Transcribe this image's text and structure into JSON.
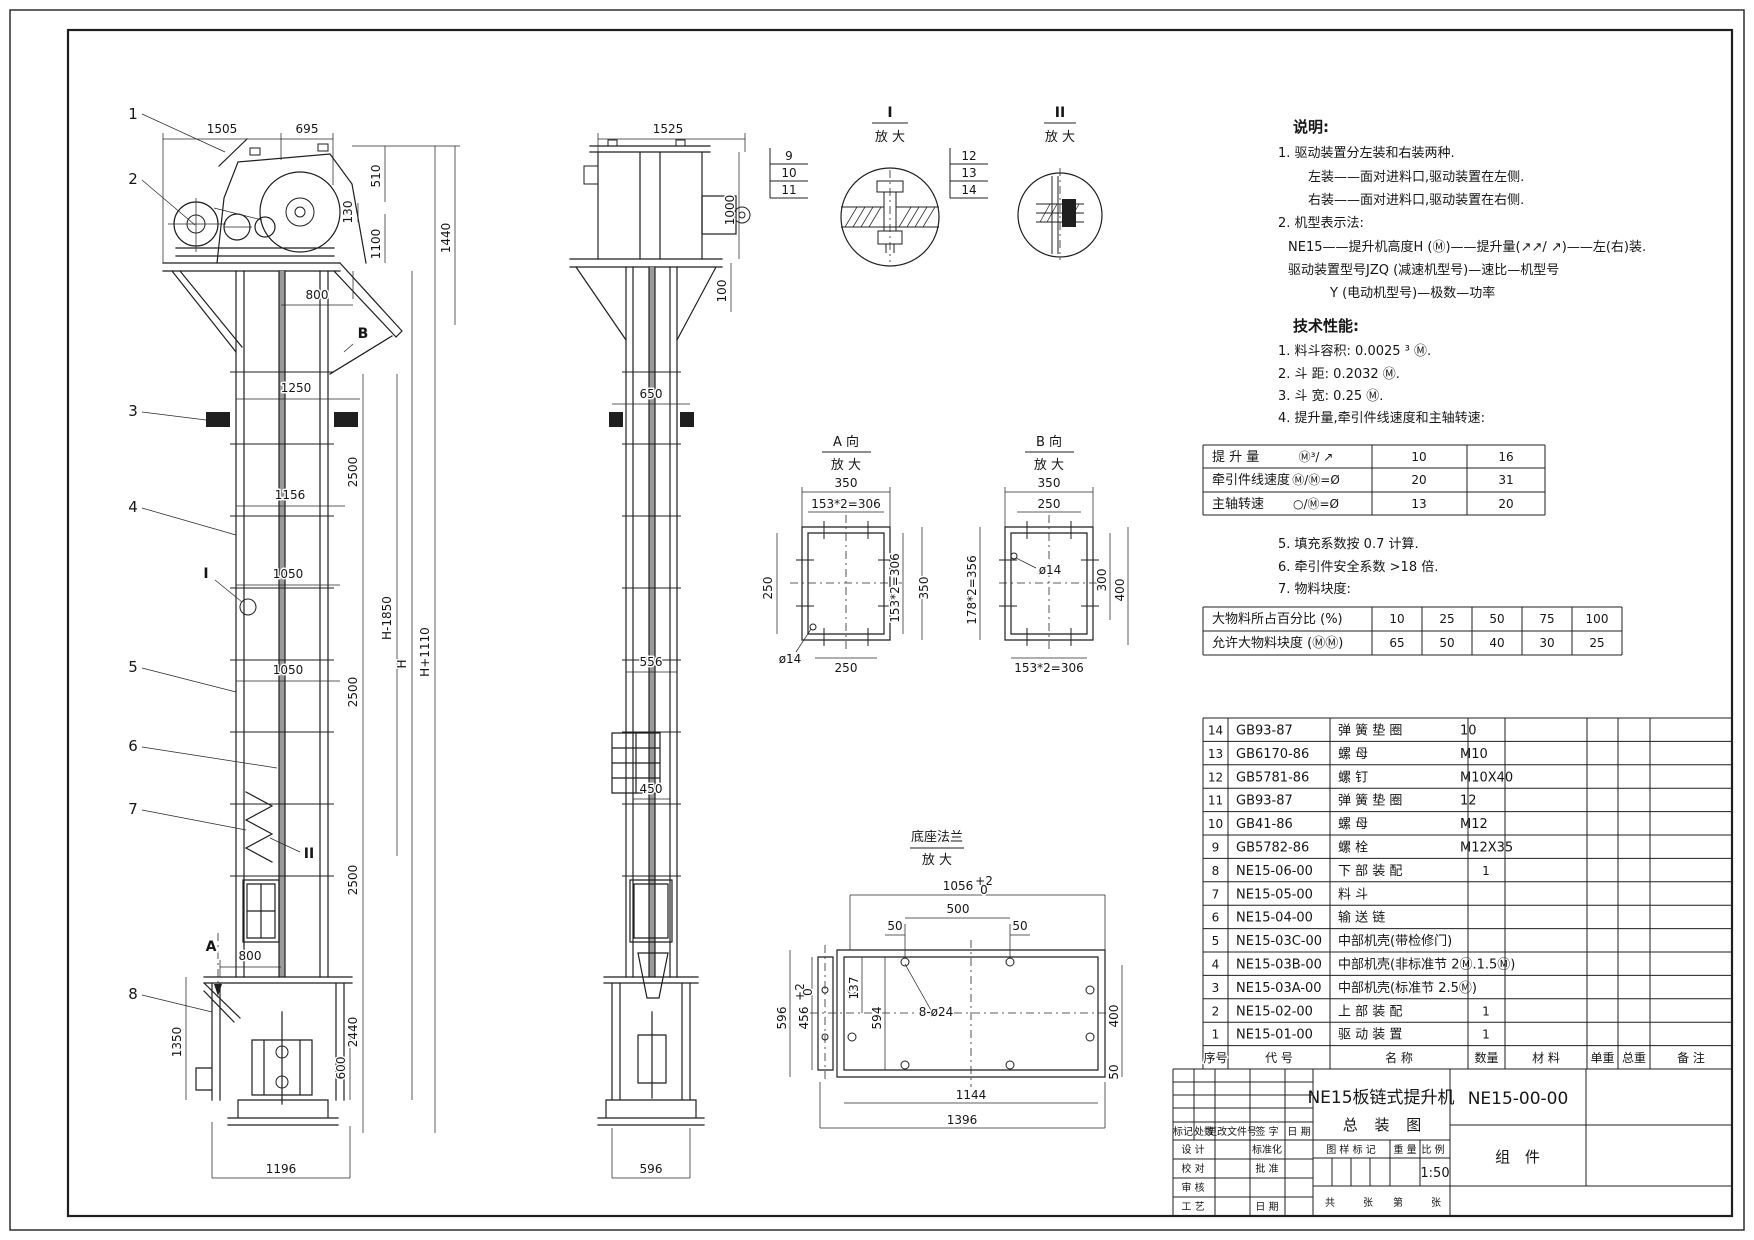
{
  "title_block": {
    "product_title_line1": "NE15板链式提升机",
    "product_title_line2": "总 装 图",
    "drawing_number": "NE15-00-00",
    "sheet_label": "组 件",
    "scale_value": "1:50",
    "cells": [
      {
        "t": "标记",
        "x": 1183,
        "y": 1135,
        "fs": 8
      },
      {
        "t": "处数",
        "x": 1204,
        "y": 1135,
        "fs": 8
      },
      {
        "t": "更改文件号",
        "x": 1232,
        "y": 1135,
        "fs": 8
      },
      {
        "t": "签  字",
        "x": 1267,
        "y": 1135,
        "fs": 8
      },
      {
        "t": "日  期",
        "x": 1299,
        "y": 1135,
        "fs": 8
      },
      {
        "t": "设  计",
        "x": 1193,
        "y": 1153,
        "fs": 10
      },
      {
        "t": "标准化",
        "x": 1267,
        "y": 1153,
        "fs": 10
      },
      {
        "t": "校  对",
        "x": 1193,
        "y": 1172,
        "fs": 10
      },
      {
        "t": "批  准",
        "x": 1267,
        "y": 1172,
        "fs": 10
      },
      {
        "t": "审  核",
        "x": 1193,
        "y": 1191,
        "fs": 10
      },
      {
        "t": "工  艺",
        "x": 1193,
        "y": 1210,
        "fs": 10
      },
      {
        "t": "日  期",
        "x": 1267,
        "y": 1210,
        "fs": 10
      },
      {
        "t": "图 样 标 记",
        "x": 1351,
        "y": 1153,
        "fs": 10
      },
      {
        "t": "重 量",
        "x": 1405,
        "y": 1153,
        "fs": 10
      },
      {
        "t": "比 例",
        "x": 1433,
        "y": 1153,
        "fs": 10
      },
      {
        "t": "共",
        "x": 1330,
        "y": 1206,
        "fs": 10
      },
      {
        "t": "张",
        "x": 1368,
        "y": 1206,
        "fs": 10
      },
      {
        "t": "第",
        "x": 1398,
        "y": 1206,
        "fs": 10
      },
      {
        "t": "张",
        "x": 1436,
        "y": 1206,
        "fs": 10
      }
    ]
  },
  "notes": [
    {
      "t": "说明:",
      "x": 1293,
      "y": 132,
      "cls": "note-h"
    },
    {
      "t": "1. 驱动装置分左装和右装两种.",
      "x": 1278,
      "y": 157
    },
    {
      "t": "左装——面对进料口,驱动装置在左侧.",
      "x": 1308,
      "y": 181
    },
    {
      "t": "右装——面对进料口,驱动装置在右侧.",
      "x": 1308,
      "y": 204
    },
    {
      "t": "2. 机型表示法:",
      "x": 1278,
      "y": 227
    },
    {
      "t": "NE15——提升机高度H (Ⓜ)——提升量(↗↗/ ↗)——左(右)装.",
      "x": 1288,
      "y": 251
    },
    {
      "t": "驱动装置型号JZQ    (减速机型号)—速比—机型号",
      "x": 1288,
      "y": 274
    },
    {
      "t": "Y  (电动机型号)—极数—功率",
      "x": 1330,
      "y": 297
    },
    {
      "t": "技术性能:",
      "x": 1293,
      "y": 331,
      "cls": "note-h"
    },
    {
      "t": "1. 料斗容积: 0.0025 ³  Ⓜ.",
      "x": 1278,
      "y": 355
    },
    {
      "t": "2. 斗    距: 0.2032  Ⓜ.",
      "x": 1278,
      "y": 378
    },
    {
      "t": "3. 斗    宽: 0.25  Ⓜ.",
      "x": 1278,
      "y": 400
    },
    {
      "t": "4. 提升量,牵引件线速度和主轴转速:",
      "x": 1278,
      "y": 422
    },
    {
      "t": "5. 填充系数按 0.7   计算.",
      "x": 1278,
      "y": 548
    },
    {
      "t": "6. 牵引件安全系数 >18   倍.",
      "x": 1278,
      "y": 571
    },
    {
      "t": "7. 物料块度:",
      "x": 1278,
      "y": 593
    }
  ],
  "annotations": {
    "front_dims": [
      {
        "t": "1505",
        "x": 222,
        "y": 133
      },
      {
        "t": "695",
        "x": 307,
        "y": 133
      },
      {
        "t": "510",
        "x": 380,
        "y": 176,
        "r": -90
      },
      {
        "t": "130",
        "x": 352,
        "y": 212,
        "r": -90,
        "fs": 10
      },
      {
        "t": "1100",
        "x": 380,
        "y": 244,
        "r": -90
      },
      {
        "t": "1440",
        "x": 450,
        "y": 238,
        "r": -90
      },
      {
        "t": "800",
        "x": 317,
        "y": 299
      },
      {
        "t": "B",
        "x": 363,
        "y": 338,
        "cls": "lbl"
      },
      {
        "t": "1250",
        "x": 296,
        "y": 392
      },
      {
        "t": "2500",
        "x": 357,
        "y": 472,
        "r": -90
      },
      {
        "t": "1156",
        "x": 290,
        "y": 499
      },
      {
        "t": "1050",
        "x": 288,
        "y": 578
      },
      {
        "t": "H-1850",
        "x": 391,
        "y": 618,
        "r": -90
      },
      {
        "t": "H",
        "x": 406,
        "y": 664,
        "r": -90
      },
      {
        "t": "H+1110",
        "x": 429,
        "y": 652,
        "r": -90
      },
      {
        "t": "I",
        "x": 206,
        "y": 578,
        "cls": "lbl"
      },
      {
        "t": "1050",
        "x": 288,
        "y": 674
      },
      {
        "t": "2500",
        "x": 357,
        "y": 692,
        "r": -90
      },
      {
        "t": "II",
        "x": 309,
        "y": 858,
        "cls": "lbl"
      },
      {
        "t": "2500",
        "x": 357,
        "y": 880,
        "r": -90
      },
      {
        "t": "A",
        "x": 211,
        "y": 951,
        "cls": "lbl"
      },
      {
        "t": "800",
        "x": 250,
        "y": 960
      },
      {
        "t": "2440",
        "x": 357,
        "y": 1032,
        "r": -90
      },
      {
        "t": "1350",
        "x": 181,
        "y": 1042,
        "r": -90
      },
      {
        "t": "600",
        "x": 345,
        "y": 1068,
        "r": -90
      },
      {
        "t": "1196",
        "x": 281,
        "y": 1173
      }
    ],
    "balloons": [
      {
        "t": "1",
        "x": 133,
        "y": 119
      },
      {
        "t": "2",
        "x": 133,
        "y": 184
      },
      {
        "t": "3",
        "x": 133,
        "y": 416
      },
      {
        "t": "4",
        "x": 133,
        "y": 512
      },
      {
        "t": "5",
        "x": 133,
        "y": 672
      },
      {
        "t": "6",
        "x": 133,
        "y": 751
      },
      {
        "t": "7",
        "x": 133,
        "y": 814
      },
      {
        "t": "8",
        "x": 133,
        "y": 999
      }
    ],
    "side_dims": [
      {
        "t": "1525",
        "x": 668,
        "y": 133
      },
      {
        "t": "1000",
        "x": 734,
        "y": 210,
        "r": -90
      },
      {
        "t": "100",
        "x": 726,
        "y": 291,
        "r": -90,
        "fs": 10
      },
      {
        "t": "650",
        "x": 651,
        "y": 398
      },
      {
        "t": "556",
        "x": 651,
        "y": 666
      },
      {
        "t": "450",
        "x": 651,
        "y": 793
      },
      {
        "t": "596",
        "x": 651,
        "y": 1173
      }
    ],
    "details": [
      {
        "t": "I",
        "x": 890,
        "y": 117,
        "cls": "lbl"
      },
      {
        "t": "放 大",
        "x": 890,
        "y": 141,
        "cls": "cjk"
      },
      {
        "t": "9",
        "x": 789,
        "y": 160
      },
      {
        "t": "10",
        "x": 789,
        "y": 177
      },
      {
        "t": "11",
        "x": 789,
        "y": 194
      },
      {
        "t": "II",
        "x": 1060,
        "y": 117,
        "cls": "lbl"
      },
      {
        "t": "放 大",
        "x": 1060,
        "y": 141,
        "cls": "cjk"
      },
      {
        "t": "12",
        "x": 969,
        "y": 160
      },
      {
        "t": "13",
        "x": 969,
        "y": 177
      },
      {
        "t": "14",
        "x": 969,
        "y": 194
      }
    ],
    "sections": [
      {
        "t": "A 向",
        "x": 846,
        "y": 446,
        "cls": "cjk"
      },
      {
        "t": "放 大",
        "x": 846,
        "y": 469,
        "cls": "cjk"
      },
      {
        "t": "350",
        "x": 846,
        "y": 487
      },
      {
        "t": "153*2=306",
        "x": 846,
        "y": 508,
        "fs": 10
      },
      {
        "t": "250",
        "x": 772,
        "y": 588,
        "r": -90
      },
      {
        "t": "153*2=306",
        "x": 899,
        "y": 588,
        "r": -90,
        "fs": 10
      },
      {
        "t": "350",
        "x": 928,
        "y": 588,
        "r": -90
      },
      {
        "t": "ø14",
        "x": 790,
        "y": 663,
        "fs": 11
      },
      {
        "t": "250",
        "x": 846,
        "y": 672
      },
      {
        "t": "B 向",
        "x": 1049,
        "y": 446,
        "cls": "cjk"
      },
      {
        "t": "放 大",
        "x": 1049,
        "y": 469,
        "cls": "cjk"
      },
      {
        "t": "350",
        "x": 1049,
        "y": 487
      },
      {
        "t": "250",
        "x": 1049,
        "y": 508
      },
      {
        "t": "178*2=356",
        "x": 976,
        "y": 590,
        "r": -90,
        "fs": 10
      },
      {
        "t": "ø14",
        "x": 1050,
        "y": 574,
        "fs": 11
      },
      {
        "t": "300",
        "x": 1106,
        "y": 580,
        "r": -90
      },
      {
        "t": "400",
        "x": 1124,
        "y": 590,
        "r": -90
      },
      {
        "t": "153*2=306",
        "x": 1049,
        "y": 672,
        "fs": 10
      }
    ],
    "base": [
      {
        "t": "底座法兰",
        "x": 937,
        "y": 841,
        "cls": "cjk"
      },
      {
        "t": "放 大",
        "x": 937,
        "y": 864,
        "cls": "cjk"
      },
      {
        "t": "1056",
        "x": 958,
        "y": 890
      },
      {
        "t": "+2",
        "x": 984,
        "y": 885,
        "fs": 8
      },
      {
        "t": "0",
        "x": 984,
        "y": 894,
        "fs": 8
      },
      {
        "t": "500",
        "x": 958,
        "y": 913
      },
      {
        "t": "50",
        "x": 895,
        "y": 930,
        "fs": 11
      },
      {
        "t": "50",
        "x": 1020,
        "y": 930,
        "fs": 11
      },
      {
        "t": "596",
        "x": 786,
        "y": 1018,
        "r": -90
      },
      {
        "t": "456",
        "x": 808,
        "y": 1018,
        "r": -90,
        "fs": 11
      },
      {
        "t": "+2",
        "x": 804,
        "y": 992,
        "r": -90,
        "fs": 7
      },
      {
        "t": "0",
        "x": 812,
        "y": 992,
        "r": -90,
        "fs": 7
      },
      {
        "t": "137",
        "x": 858,
        "y": 988,
        "r": -90,
        "fs": 10
      },
      {
        "t": "594",
        "x": 881,
        "y": 1018,
        "r": -90,
        "fs": 11
      },
      {
        "t": "8-ø24",
        "x": 936,
        "y": 1016,
        "a": "start",
        "fs": 11
      },
      {
        "t": "400",
        "x": 1118,
        "y": 1016,
        "r": -90
      },
      {
        "t": "50",
        "x": 1118,
        "y": 1072,
        "r": -90,
        "fs": 10
      },
      {
        "t": "1144",
        "x": 971,
        "y": 1099
      },
      {
        "t": "1396",
        "x": 962,
        "y": 1124
      }
    ]
  },
  "tables": {
    "performance": {
      "rows": [
        {
          "label": "提 升 量",
          "formula": "Ⓜ³/ ↗",
          "values": [
            "10",
            "16"
          ]
        },
        {
          "label": "牵引件线速度",
          "formula": "Ⓜ/Ⓜ=Ø",
          "values": [
            "20",
            "31"
          ]
        },
        {
          "label": "主轴转速",
          "formula": "○/Ⓜ=Ø",
          "values": [
            "13",
            "20"
          ]
        }
      ]
    },
    "lump": {
      "rows": [
        {
          "label": "大物料所占百分比  (%)",
          "values": [
            "10",
            "25",
            "50",
            "75",
            "100"
          ]
        },
        {
          "label": "允许大物料块度  (ⓂⓂ)",
          "values": [
            "65",
            "50",
            "40",
            "30",
            "25"
          ]
        }
      ]
    },
    "bom": {
      "header": {
        "seq": "序号",
        "code": "代     号",
        "name": "名      称",
        "qty": "数量",
        "material": "材 料",
        "unit_weight": "单重",
        "total_weight": "总重",
        "remark": "备 注"
      },
      "items": [
        {
          "seq": "14",
          "code": "GB93-87",
          "name": "弹 簧 垫 圈",
          "spec": "10",
          "qty": ""
        },
        {
          "seq": "13",
          "code": "GB6170-86",
          "name": "螺 母",
          "spec": "M10",
          "qty": ""
        },
        {
          "seq": "12",
          "code": "GB5781-86",
          "name": "螺 钉",
          "spec": "M10X40",
          "qty": ""
        },
        {
          "seq": "11",
          "code": "GB93-87",
          "name": "弹 簧 垫 圈",
          "spec": "12",
          "qty": ""
        },
        {
          "seq": "10",
          "code": "GB41-86",
          "name": "螺 母",
          "spec": "M12",
          "qty": ""
        },
        {
          "seq": "9",
          "code": "GB5782-86",
          "name": "螺 栓",
          "spec": "M12X35",
          "qty": ""
        },
        {
          "seq": "8",
          "code": "NE15-06-00",
          "name": "下 部 装 配",
          "spec": "",
          "qty": "1"
        },
        {
          "seq": "7",
          "code": "NE15-05-00",
          "name": "料 斗",
          "spec": "",
          "qty": ""
        },
        {
          "seq": "6",
          "code": "NE15-04-00",
          "name": "输 送 链",
          "spec": "",
          "qty": ""
        },
        {
          "seq": "5",
          "code": "NE15-03C-00",
          "name": "中部机壳(带检修门)",
          "spec": "",
          "qty": ""
        },
        {
          "seq": "4",
          "code": "NE15-03B-00",
          "name": "中部机壳(非标准节 2Ⓜ.1.5Ⓜ)",
          "spec": "",
          "qty": ""
        },
        {
          "seq": "3",
          "code": "NE15-03A-00",
          "name": "中部机壳(标准节 2.5Ⓜ)",
          "spec": "",
          "qty": ""
        },
        {
          "seq": "2",
          "code": "NE15-02-00",
          "name": "上 部 装 配",
          "spec": "",
          "qty": "1"
        },
        {
          "seq": "1",
          "code": "NE15-01-00",
          "name": "驱 动 装 置",
          "spec": "",
          "qty": "1"
        }
      ]
    }
  }
}
